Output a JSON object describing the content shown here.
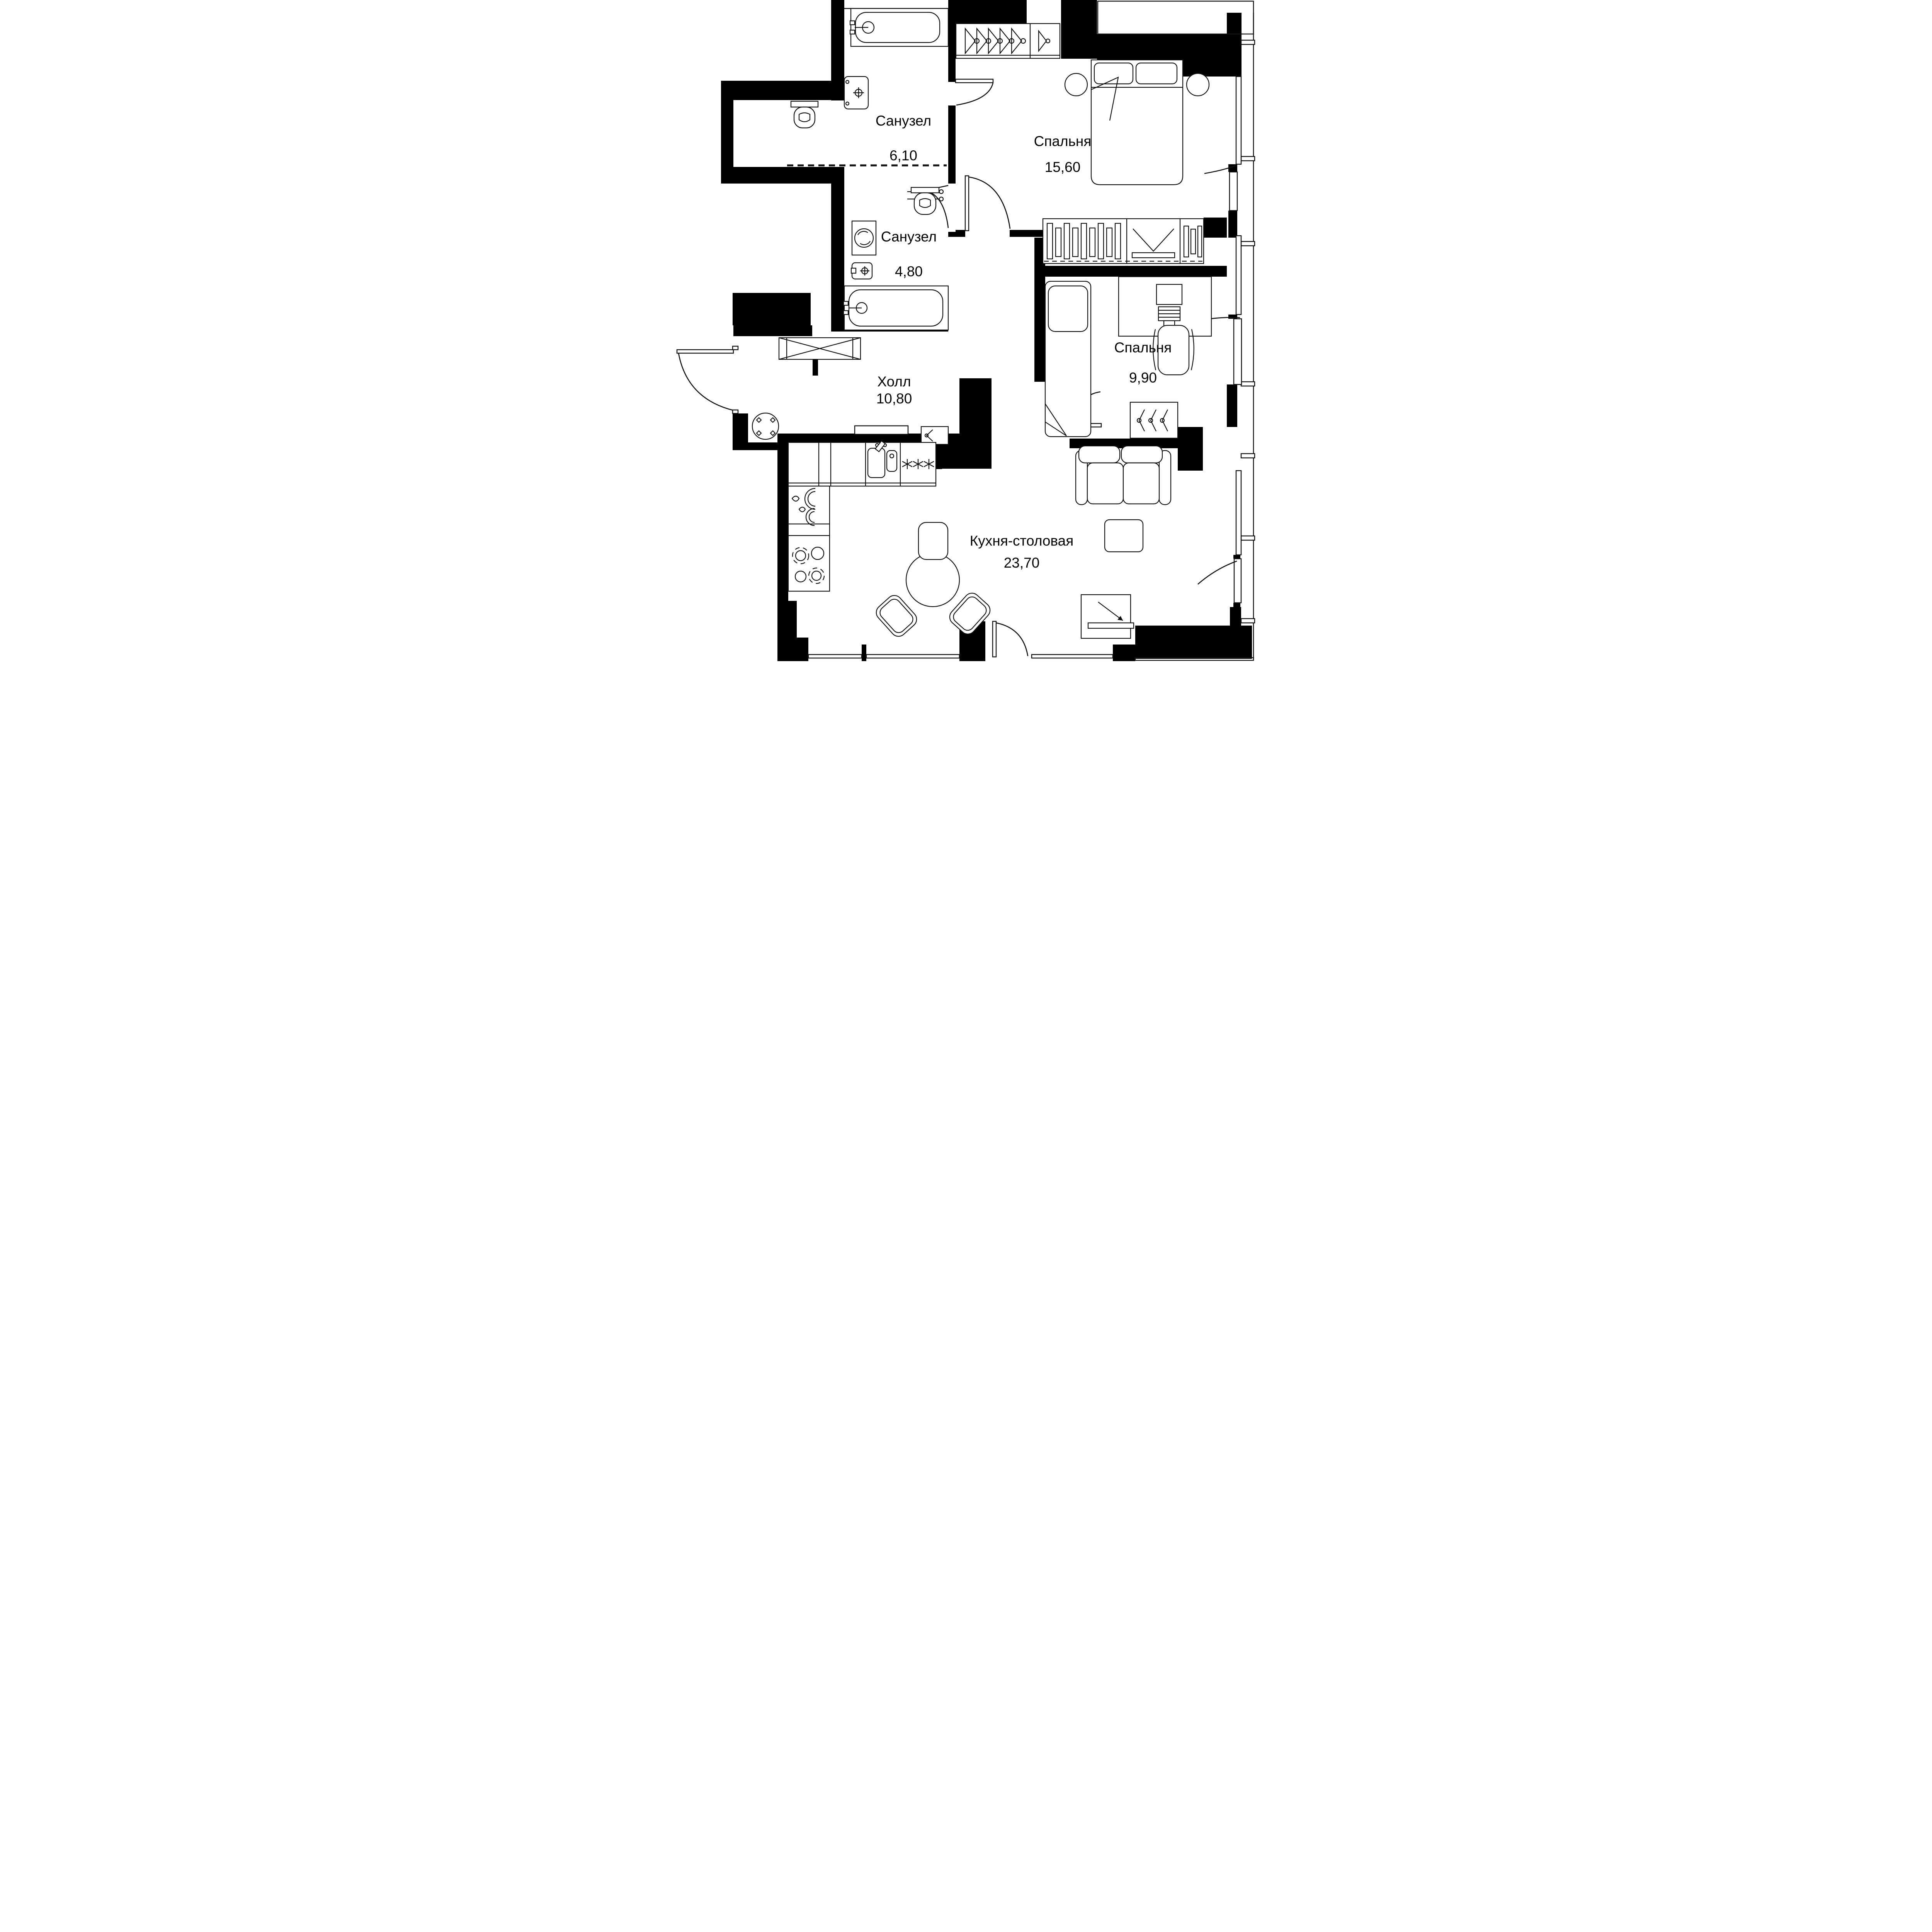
{
  "plan": {
    "title": "Apartment floor plan",
    "rooms": [
      {
        "id": "bathroom-1",
        "name": "Санузел",
        "area": "6,10"
      },
      {
        "id": "bedroom-1",
        "name": "Спальня",
        "area": "15,60"
      },
      {
        "id": "bathroom-2",
        "name": "Санузел",
        "area": "4,80"
      },
      {
        "id": "bedroom-2",
        "name": "Спальня",
        "area": "9,90"
      },
      {
        "id": "hall",
        "name": "Холл",
        "area": "10,80"
      },
      {
        "id": "kitchen-dining",
        "name": "Кухня-столовая",
        "area": "23,70"
      }
    ],
    "fixtures": [
      "bathtub",
      "sink",
      "toilet",
      "washing-machine",
      "towel-dryer",
      "double-bed",
      "single-bed",
      "nightstand",
      "wardrobe",
      "closet",
      "desk",
      "office-chair",
      "sofa",
      "coffee-table",
      "dining-table",
      "dining-chair",
      "round-table",
      "kitchen-counter",
      "kitchen-sink",
      "cooktop",
      "entrance-door",
      "interior-door",
      "balcony-door",
      "window",
      "balcony"
    ],
    "colors": {
      "wall": "#000000",
      "line": "#111111",
      "background": "#ffffff"
    }
  }
}
